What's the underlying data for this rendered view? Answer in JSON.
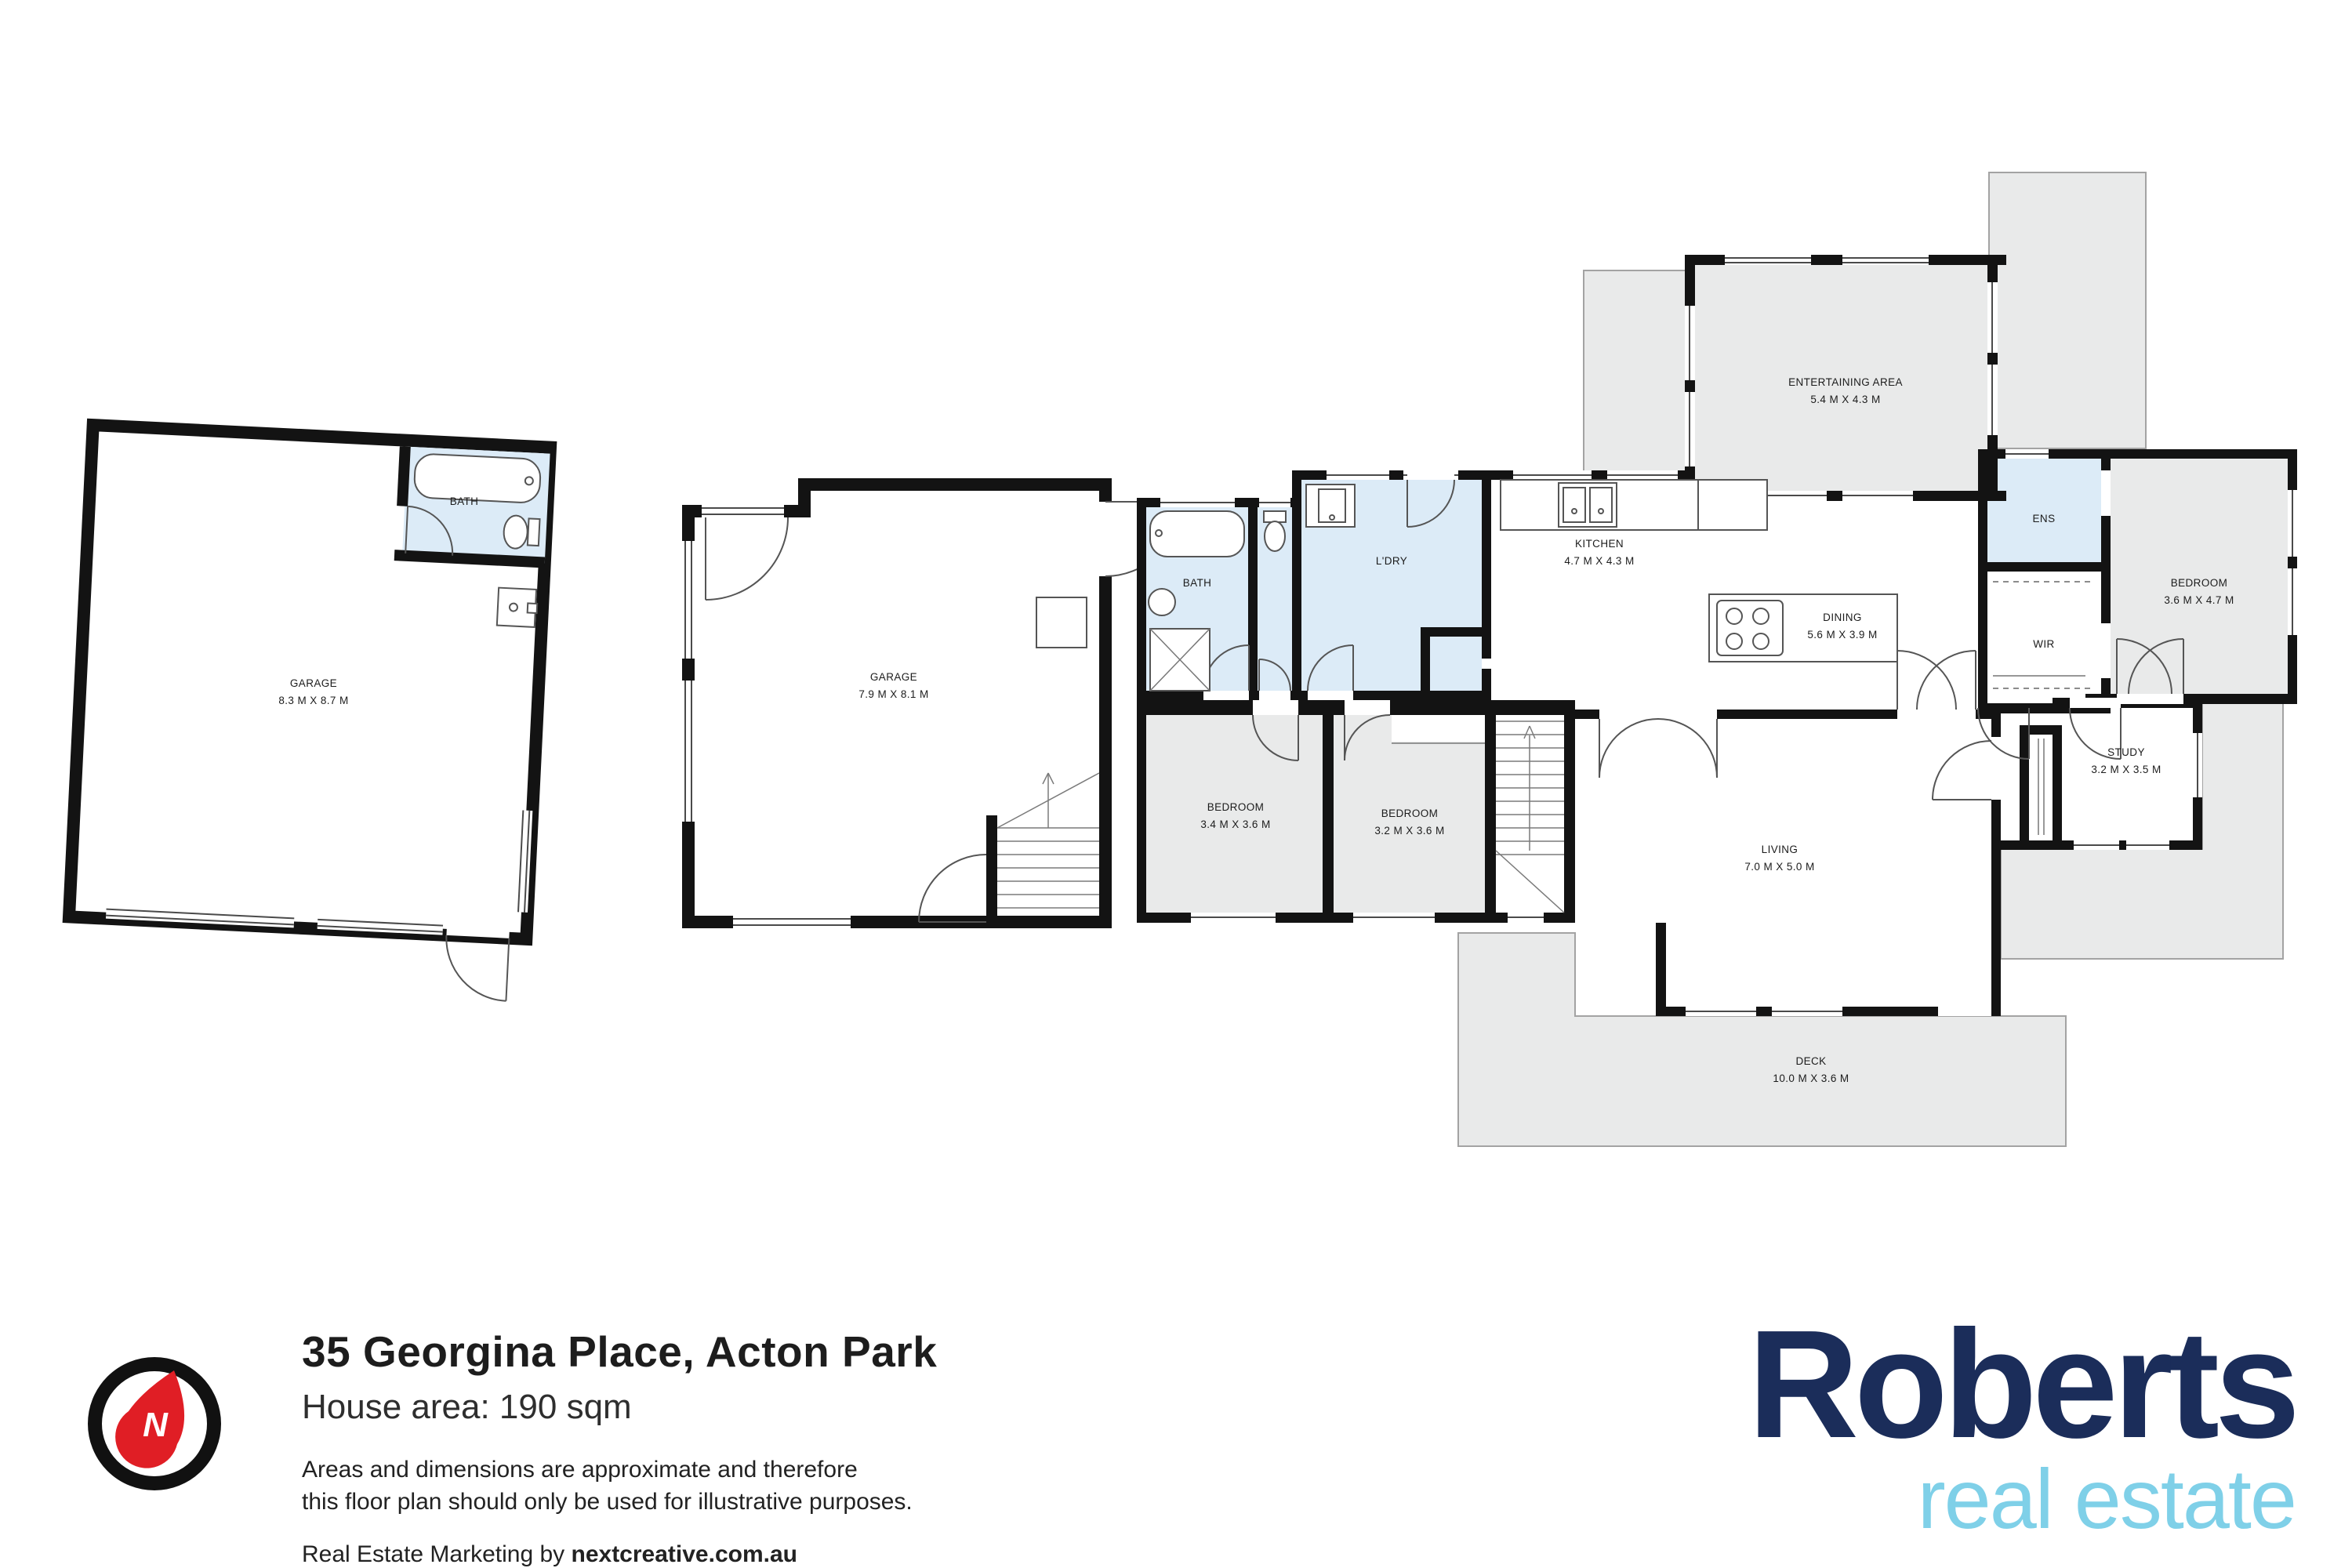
{
  "title": "35 Georgina Place, Acton Park floor plan",
  "info": {
    "address": "35 Georgina Place, Acton Park",
    "house_area": "House area: 190 sqm",
    "disclaimer_line1": "Areas and dimensions are approximate and therefore",
    "disclaimer_line2": "this floor plan should only be used for illustrative purposes.",
    "marketing_prefix": "Real Estate Marketing by ",
    "marketing_domain": "nextcreative.com.au"
  },
  "logo": {
    "brand": "Roberts",
    "tagline": "real estate",
    "brand_color": "#1b2d5a",
    "tagline_color": "#7fd0e8"
  },
  "compass": {
    "label": "N",
    "needle_color": "#e01e25",
    "ring_color": "#111111"
  },
  "colors": {
    "wall": "#131313",
    "wet_room_fill": "#dcebf7",
    "outdoor_fill": "#e9eaea"
  },
  "rooms": [
    {
      "id": "garage-left",
      "name": "GARAGE",
      "dims": "8.3 M X 8.7 M"
    },
    {
      "id": "garage-left-bath",
      "name": "BATH",
      "dims": ""
    },
    {
      "id": "garage-right",
      "name": "GARAGE",
      "dims": "7.9 M X 8.1 M"
    },
    {
      "id": "bath",
      "name": "BATH",
      "dims": ""
    },
    {
      "id": "laundry",
      "name": "L'DRY",
      "dims": ""
    },
    {
      "id": "kitchen",
      "name": "KITCHEN",
      "dims": "4.7 M X 4.3 M"
    },
    {
      "id": "entertaining",
      "name": "ENTERTAINING AREA",
      "dims": "5.4 M X 4.3 M"
    },
    {
      "id": "dining",
      "name": "DINING",
      "dims": "5.6 M X 3.9 M"
    },
    {
      "id": "ens",
      "name": "ENS",
      "dims": ""
    },
    {
      "id": "wir",
      "name": "WIR",
      "dims": ""
    },
    {
      "id": "bedroom-main",
      "name": "BEDROOM",
      "dims": "3.6 M X 4.7 M"
    },
    {
      "id": "bedroom-2",
      "name": "BEDROOM",
      "dims": "3.4 M X 3.6 M"
    },
    {
      "id": "bedroom-3",
      "name": "BEDROOM",
      "dims": "3.2 M X 3.6 M"
    },
    {
      "id": "living",
      "name": "LIVING",
      "dims": "7.0 M X 5.0 M"
    },
    {
      "id": "study",
      "name": "STUDY",
      "dims": "3.2 M X 3.5 M"
    },
    {
      "id": "deck",
      "name": "DECK",
      "dims": "10.0 M X 3.6 M"
    }
  ]
}
